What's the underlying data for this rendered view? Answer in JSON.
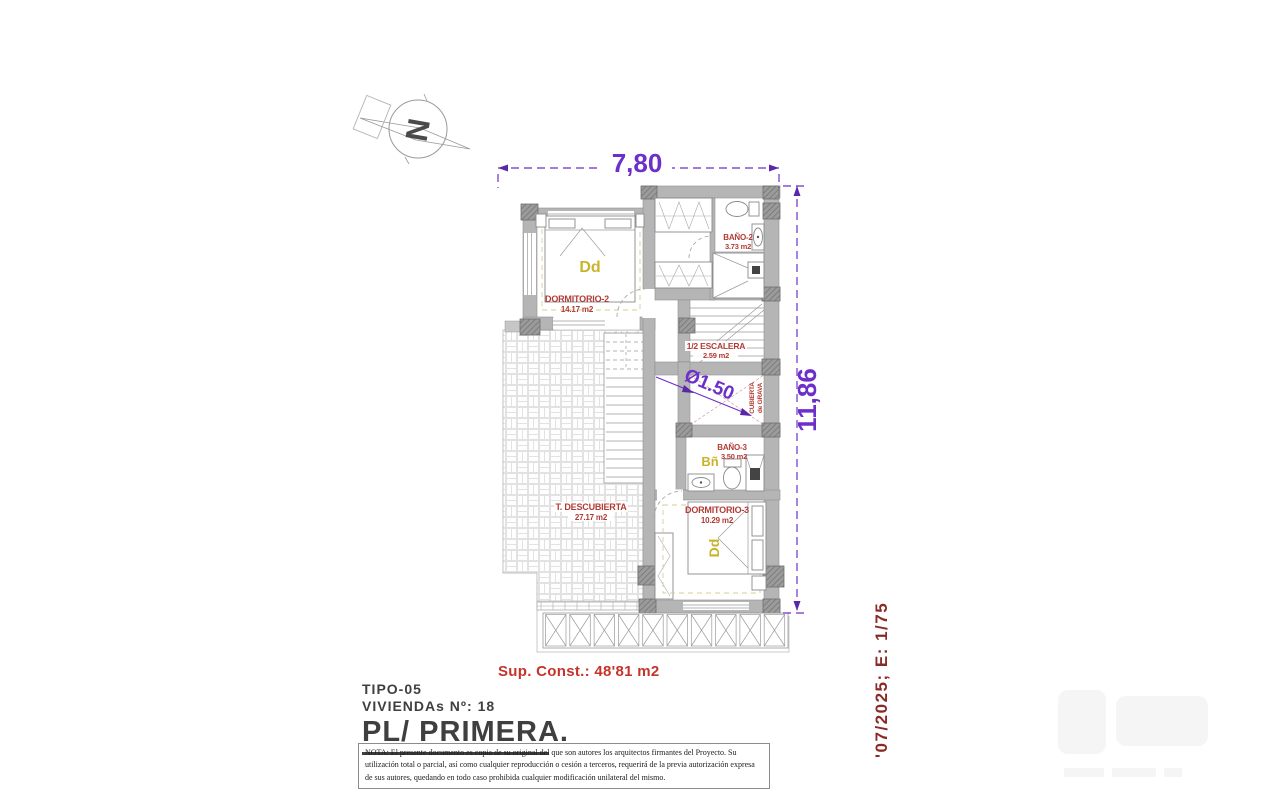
{
  "plan": {
    "north_label": "N",
    "dimensions": {
      "width_label": "7,80",
      "height_label": "11,86",
      "patio_label": "Ø1.50"
    },
    "rooms": {
      "dormitorio2": {
        "name": "DORMITORIO-2",
        "area": "14.17 m2",
        "tag": "Dd"
      },
      "bano2": {
        "name": "BAÑO-2",
        "area": "3.73 m2"
      },
      "escalera": {
        "name": "1/2 ESCALERA",
        "area": "2.59 m2"
      },
      "patio": {
        "label_line1": "CUBIERTA",
        "label_line2": "de GRAVA"
      },
      "bano3": {
        "name": "BAÑO-3",
        "area": "3.50 m2",
        "tag": "Bñ"
      },
      "dormitorio3": {
        "name": "DORMITORIO-3",
        "area": "10.29 m2",
        "tag": "Dd"
      },
      "terraza": {
        "name": "T. DESCUBIERTA",
        "area": "27.17 m2"
      }
    }
  },
  "summary": {
    "sup_const": "Sup. Const.: 48'81 m2"
  },
  "title_block": {
    "tipo": "TIPO-05",
    "viviendas": "VIVIENDAs Nº: 18",
    "plan_title": "PL/ PRIMERA."
  },
  "note": "NOTA: El presente documento es copia de su original del que son autores los arquitectos firmantes del Proyecto. Su utilización total o parcial, así como cualquier reproducción o cesión a terceros, requerirá  de la previa autorización expresa de sus autores, quedando en todo caso prohibida cualquier modificación unilateral del mismo.",
  "footer": {
    "date_scale": "'07/2025; E: 1/75"
  },
  "colors": {
    "dimension_purple": "#6d2fc9",
    "label_red": "#b13c34",
    "accent_red": "#c6332a",
    "tag_yellow": "#c9b32c",
    "date_maroon": "#8a2a25",
    "wall_gray": "#b5b5b5"
  }
}
